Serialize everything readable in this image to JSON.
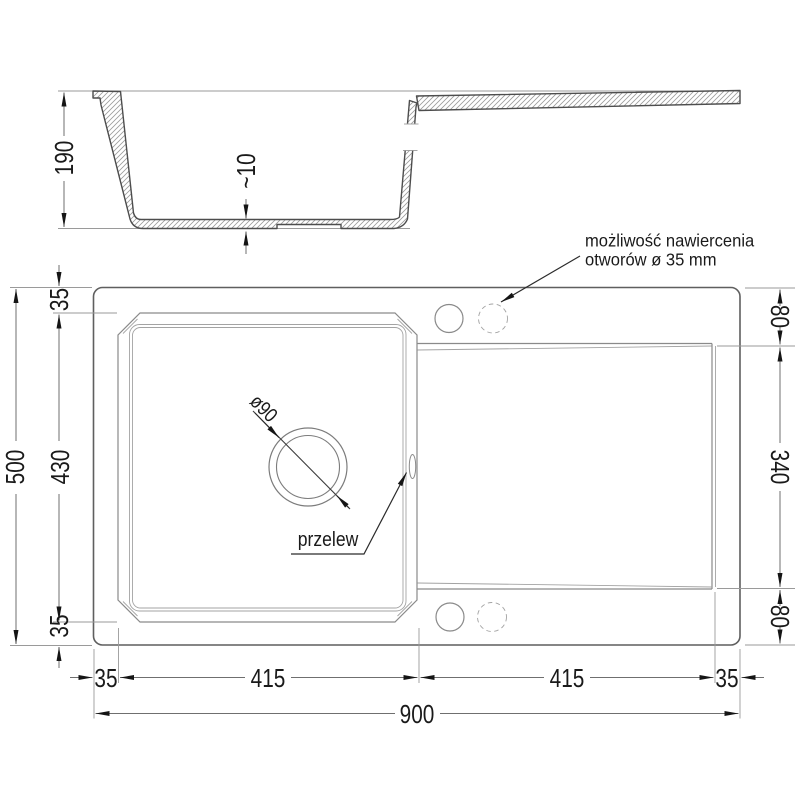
{
  "drawing": {
    "section": {
      "depth": "190",
      "bottom_thickness": "~10"
    },
    "plan": {
      "overall_height": "500",
      "left_dims": [
        "35",
        "430",
        "35"
      ],
      "right_dims": [
        "80",
        "340",
        "80"
      ],
      "bottom_dims": [
        "35",
        "415",
        "415",
        "35"
      ],
      "overall_width": "900",
      "drain_diameter": "ø90",
      "overflow_label": "przelew",
      "drill_note_line1": "możliwość nawiercenia",
      "drill_note_line2": "otworów ø 35 mm"
    }
  }
}
